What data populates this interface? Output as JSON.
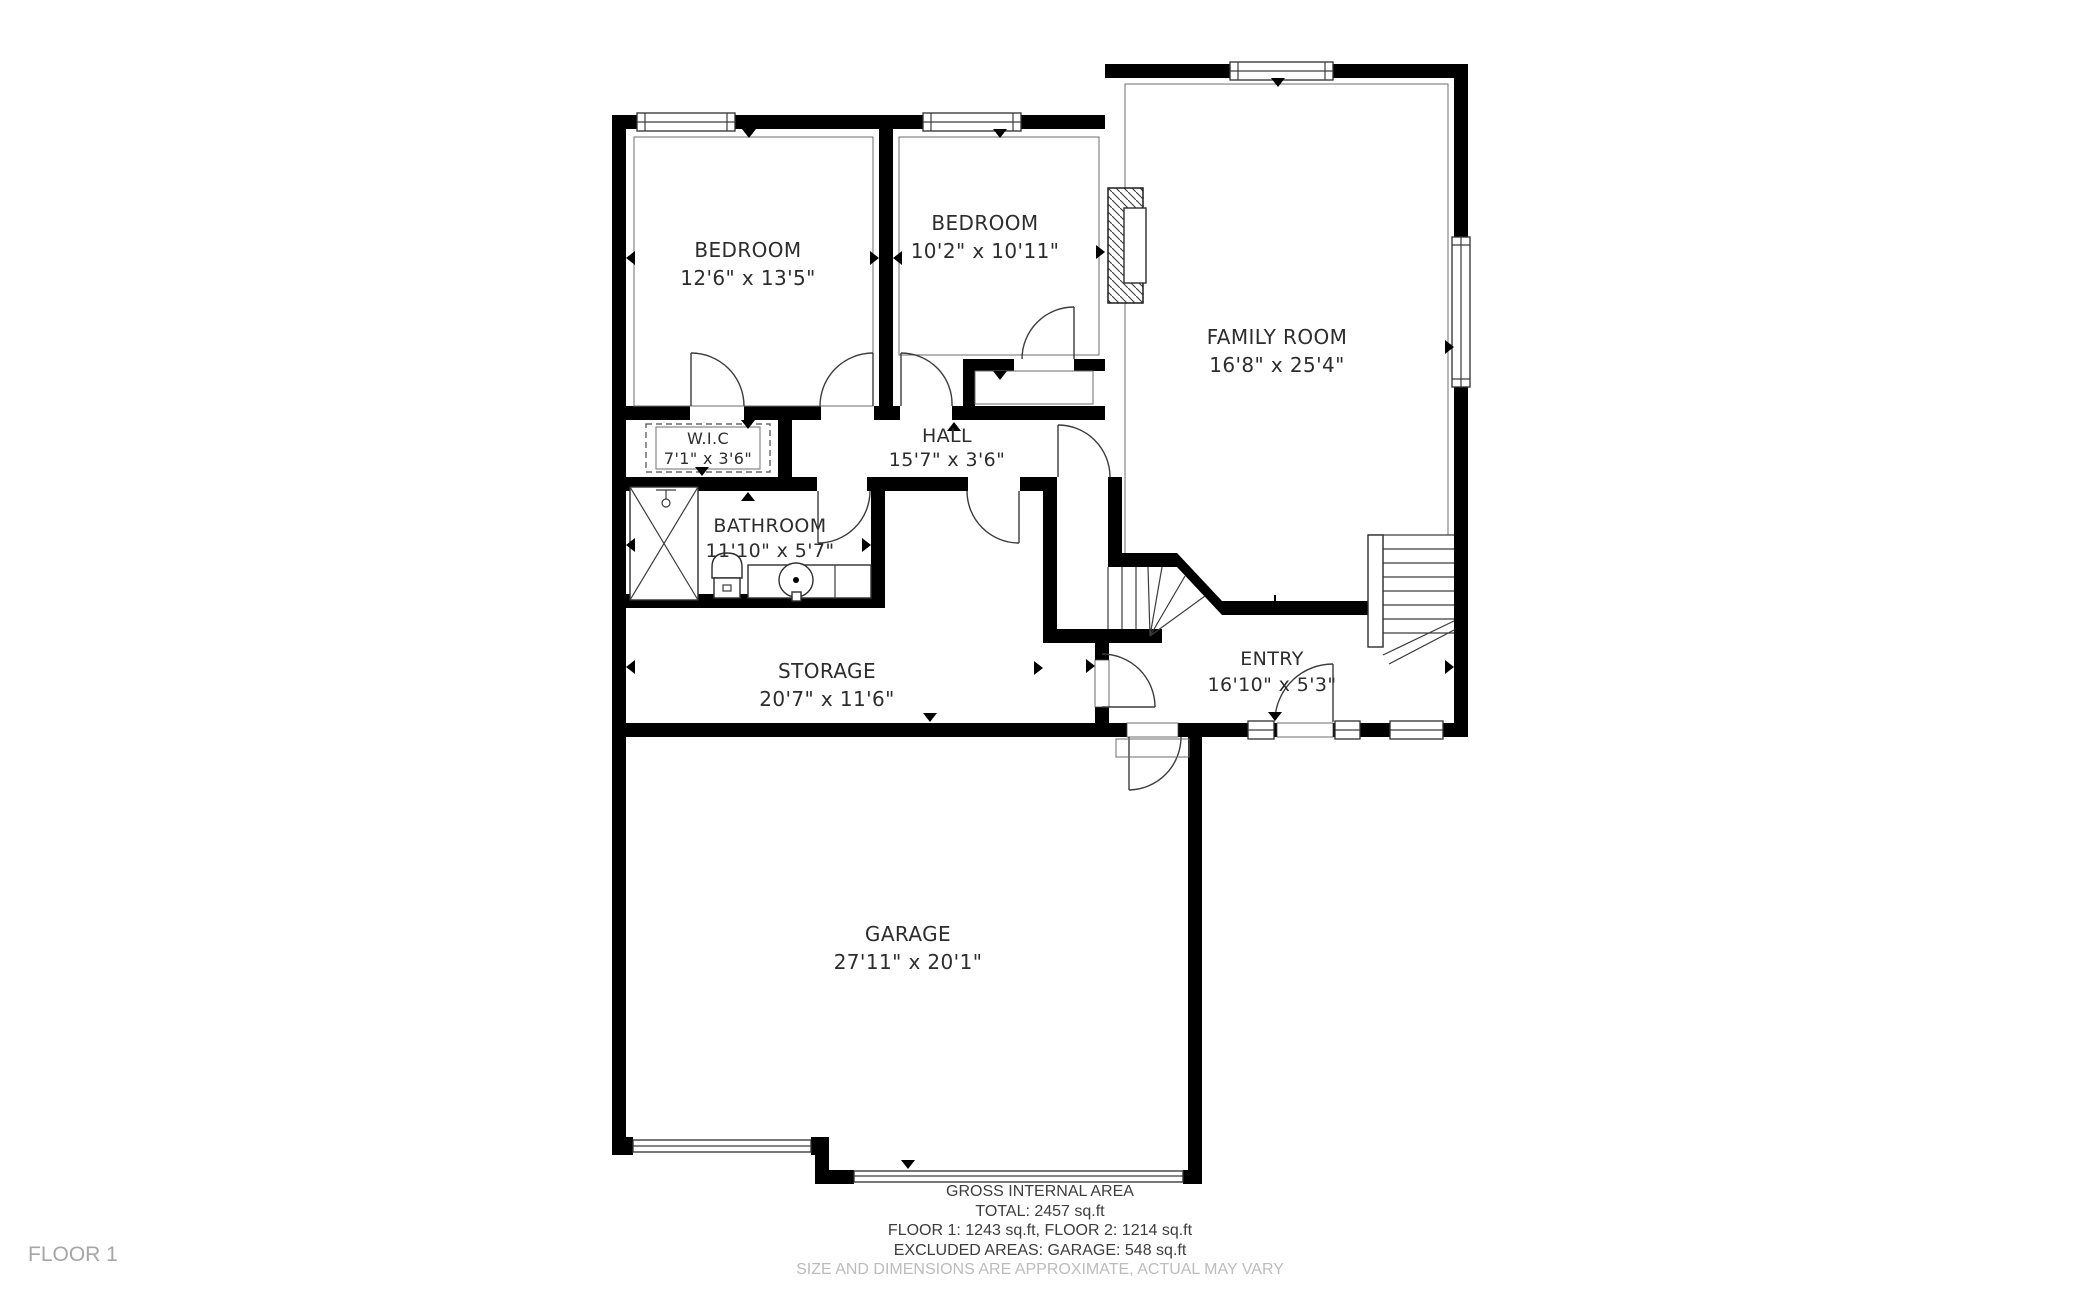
{
  "rooms": {
    "bedroom1": {
      "name": "BEDROOM",
      "dims": "12'6\" x 13'5\""
    },
    "bedroom2": {
      "name": "BEDROOM",
      "dims": "10'2\" x 10'11\""
    },
    "family_room": {
      "name": "FAMILY ROOM",
      "dims": "16'8\" x 25'4\""
    },
    "wic": {
      "name": "W.I.C",
      "dims": "7'1\" x 3'6\""
    },
    "hall": {
      "name": "HALL",
      "dims": "15'7\" x 3'6\""
    },
    "bathroom": {
      "name": "BATHROOM",
      "dims": "11'10\" x 5'7\""
    },
    "storage": {
      "name": "STORAGE",
      "dims": "20'7\" x 11'6\""
    },
    "entry": {
      "name": "ENTRY",
      "dims": "16'10\" x 5'3\""
    },
    "garage": {
      "name": "GARAGE",
      "dims": "27'11\" x 20'1\""
    }
  },
  "footer": {
    "line1": "GROSS INTERNAL AREA",
    "line2": "TOTAL: 2457 sq.ft",
    "line3": "FLOOR 1: 1243 sq.ft, FLOOR 2: 1214 sq.ft",
    "line4": "EXCLUDED AREAS: GARAGE: 548 sq.ft",
    "disclaimer": "SIZE AND DIMENSIONS ARE APPROXIMATE, ACTUAL MAY VARY"
  },
  "floor_label": "FLOOR 1",
  "colors": {
    "wall": "#000000",
    "line": "#3c3c3c",
    "muted_text": "#bcbcbc"
  }
}
